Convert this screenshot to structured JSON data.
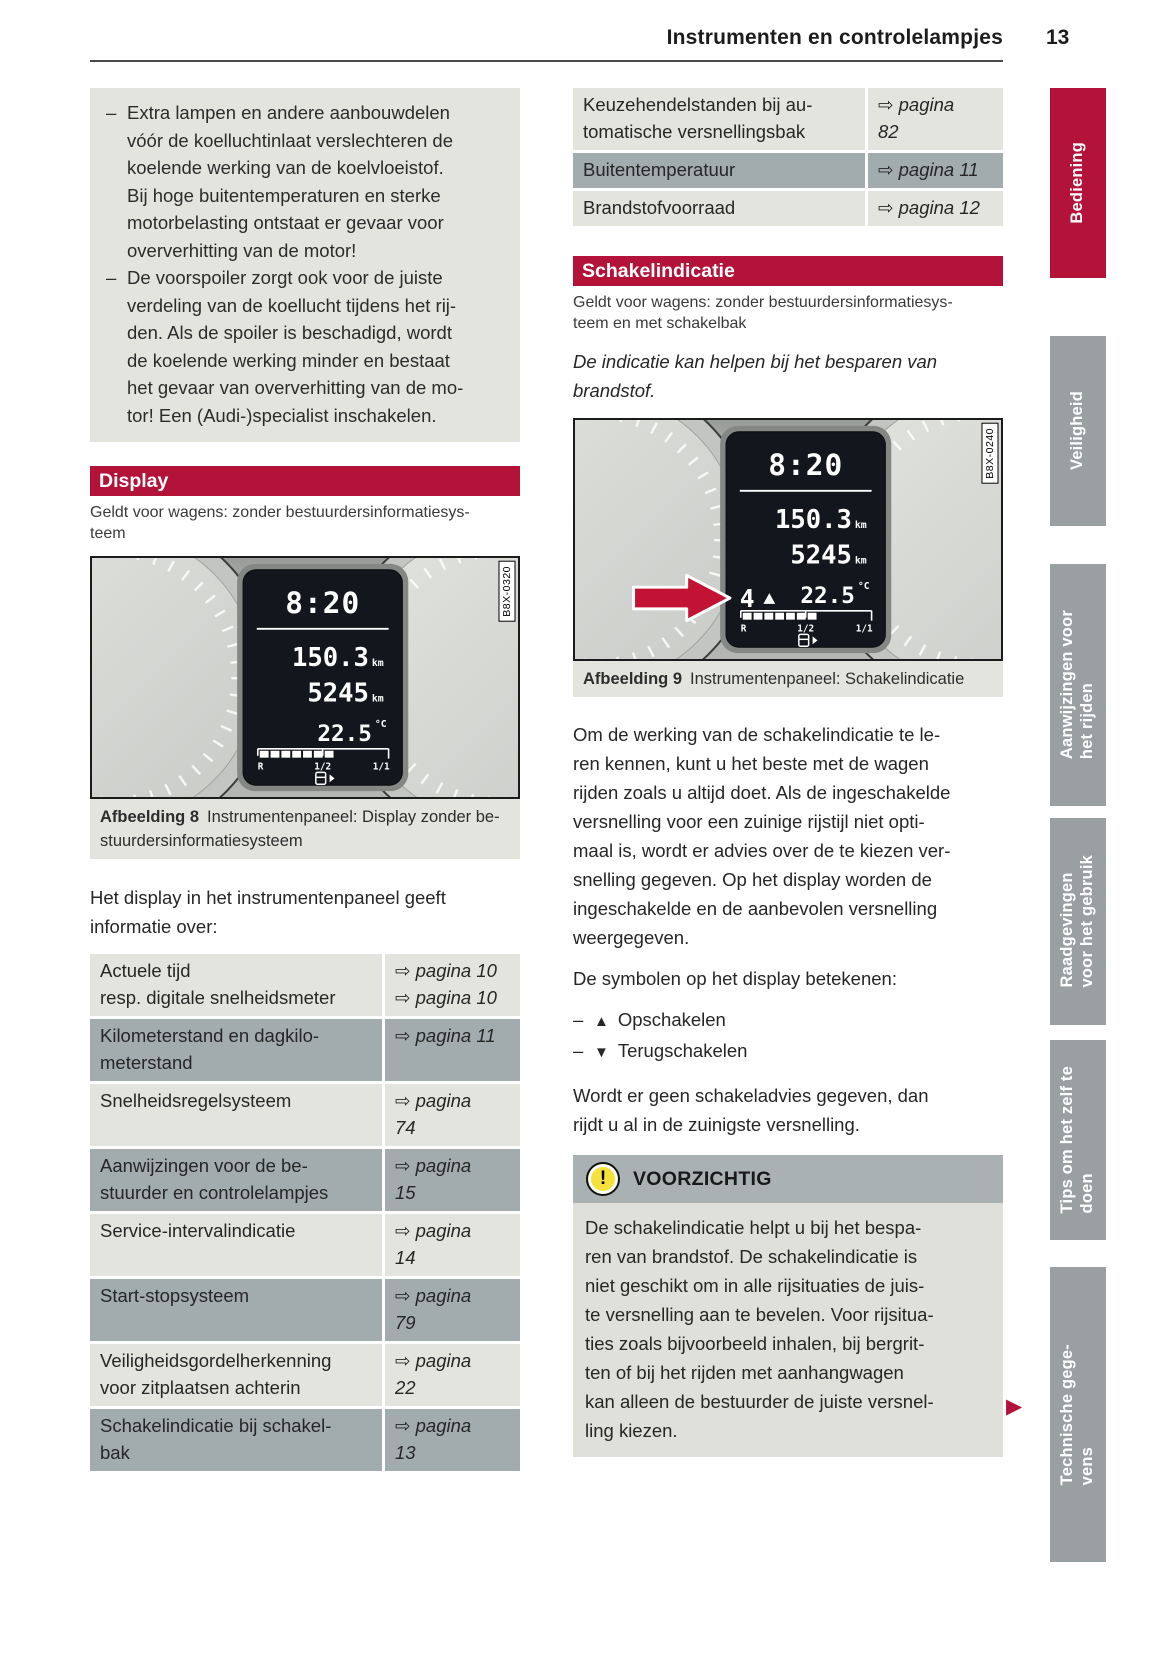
{
  "page": {
    "title": "Instrumenten en controlelampjes",
    "number": "13"
  },
  "glyphs": {
    "dash": "–",
    "continue_marker": "▶"
  },
  "colors": {
    "accent_red": "#b41339",
    "tab_gray": "#9aa0a2",
    "row_light": "#e4e4df",
    "row_dark": "#a2acaf",
    "caution_header": "#a9b1b2",
    "caution_body": "#e0e0da",
    "lcd_black": "#14161d"
  },
  "sidebar": {
    "tabs": [
      {
        "label": "Bediening",
        "active": true
      },
      {
        "label": "Veiligheid",
        "active": false
      },
      {
        "label": "Aanwijzingen voor\nhet rijden",
        "active": false
      },
      {
        "label": "Raadgevingen\nvoor het gebruik",
        "active": false
      },
      {
        "label": "Tips om het zelf te\ndoen",
        "active": false
      },
      {
        "label": "Technische gege-\nvens",
        "active": false
      }
    ]
  },
  "left": {
    "note": {
      "items": [
        "Extra lampen en andere aanbouwdelen\nvóór de koelluchtinlaat verslechteren de\nkoelende werking van de koelvloeistof.\nBij hoge buitentemperaturen en sterke\nmotorbelasting ontstaat er gevaar voor\noververhitting van de motor!",
        "De voorspoiler zorgt ook voor de juiste\nverdeling van de koellucht tijdens het rij-\nden. Als de spoiler is beschadigd, wordt\nde koelende werking minder en bestaat\nhet gevaar van oververhitting van de mo-\ntor! Een (Audi-)specialist inschakelen."
      ]
    },
    "display_section": {
      "title": "Display",
      "applies": "Geldt voor wagens: zonder bestuurdersinformatiesys-\nteem"
    },
    "figure8": {
      "code": "B8X-0320",
      "caption_label": "Afbeelding 8",
      "caption": "Instrumentenpaneel: Display zonder be-\nstuurdersinformatiesysteem",
      "display": {
        "time": "8:20",
        "trip": "150.3",
        "trip_unit": "km",
        "odometer": "5245",
        "odometer_unit": "km",
        "temperature": "22.5",
        "temperature_unit": "°C",
        "fuel_reserve": "R",
        "fuel_half": "1/2",
        "fuel_full": "1/1"
      }
    },
    "intro": "Het display in het instrumentenpaneel geeft\ninformatie over:",
    "table": {
      "rows": [
        {
          "label": "Actuele tijd\nresp. digitale snelheidsmeter",
          "ref": "⇨ pagina 10\n⇨ pagina 10"
        },
        {
          "label": "Kilometerstand en dagkilo-\nmeterstand",
          "ref": "⇨ pagina 11"
        },
        {
          "label": "Snelheidsregelsysteem",
          "ref": "⇨ pagina\n74"
        },
        {
          "label": "Aanwijzingen voor de be-\nstuurder en controlelampjes",
          "ref": "⇨ pagina\n15"
        },
        {
          "label": "Service-intervalindicatie",
          "ref": "⇨ pagina\n14"
        },
        {
          "label": "Start-stopsysteem",
          "ref": "⇨ pagina\n79"
        },
        {
          "label": "Veiligheidsgordelherkenning\nvoor zitplaatsen achterin",
          "ref": "⇨ pagina\n22"
        },
        {
          "label": "Schakelindicatie bij schakel-\nbak",
          "ref": "⇨ pagina\n13"
        }
      ]
    }
  },
  "right": {
    "table": {
      "rows": [
        {
          "label": "Keuzehendelstanden bij au-\ntomatische versnellingsbak",
          "ref": "⇨ pagina\n82"
        },
        {
          "label": "Buitentemperatuur",
          "ref": "⇨ pagina 11"
        },
        {
          "label": "Brandstofvoorraad",
          "ref": "⇨ pagina 12"
        }
      ]
    },
    "shift_section": {
      "title": "Schakelindicatie",
      "applies": "Geldt voor wagens: zonder bestuurdersinformatiesys-\nteem en met schakelbak",
      "lead": "De indicatie kan helpen bij het besparen van\nbrandstof."
    },
    "figure9": {
      "code": "B8X-0240",
      "caption_label": "Afbeelding 9",
      "caption": "Instrumentenpaneel: Schakelindicatie",
      "display": {
        "time": "8:20",
        "trip": "150.3",
        "trip_unit": "km",
        "odometer": "5245",
        "odometer_unit": "km",
        "gear": "4",
        "temperature": "22.5",
        "temperature_unit": "°C",
        "fuel_reserve": "R",
        "fuel_half": "1/2",
        "fuel_full": "1/1"
      }
    },
    "para1": "Om de werking van de schakelindicatie te le-\nren kennen, kunt u het beste met de wagen\nrijden zoals u altijd doet. Als de ingeschakelde\nversnelling voor een zuinige rijstijl niet opti-\nmaal is, wordt er advies over de te kiezen ver-\nsnelling gegeven. Op het display worden de\ningeschakelde en de aanbevolen versnelling\nweergegeven.",
    "symbols_intro": "De symbolen op het display betekenen:",
    "symbols": [
      {
        "symbol": "▲",
        "meaning": "Opschakelen"
      },
      {
        "symbol": "▼",
        "meaning": "Terugschakelen"
      }
    ],
    "para2": "Wordt er geen schakeladvies gegeven, dan\nrijdt u al in de zuinigste versnelling.",
    "caution": {
      "icon": "!",
      "title": "VOORZICHTIG",
      "body": "De schakelindicatie helpt u bij het bespa-\nren van brandstof. De schakelindicatie is\nniet geschikt om in alle rijsituaties de juis-\nte versnelling aan te bevelen. Voor rijsitua-\nties zoals bijvoorbeeld inhalen, bij bergrit-\nten of bij het rijden met aanhangwagen\nkan alleen de bestuurder de juiste versnel-\nling kiezen."
    }
  }
}
